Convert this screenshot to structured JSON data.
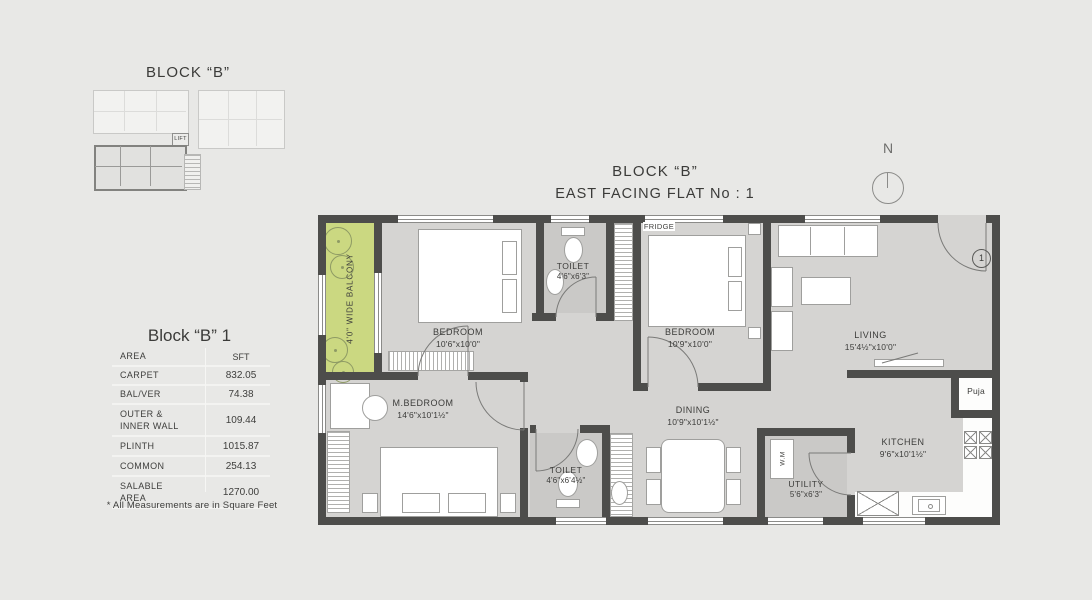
{
  "page": {
    "background": "#e8e8e6"
  },
  "colors": {
    "wall": "#4d4d4b",
    "floor": "#d5d4d2",
    "wet_floor": "#cac9c7",
    "balcony_green": "#cbd881",
    "line": "#8b8b89",
    "text": "#3e3e3c"
  },
  "mini_plan": {
    "title": "BLOCK “B”",
    "lift_label": "LIFT"
  },
  "area_table": {
    "title": "Block “B” 1",
    "header": {
      "area": "AREA",
      "sft": "SFT"
    },
    "rows": [
      {
        "label": "CARPET",
        "value": "832.05"
      },
      {
        "label": "BAL/VER",
        "value": "74.38"
      },
      {
        "label": "OUTER &\nINNER WALL",
        "value": "109.44"
      },
      {
        "label": "PLINTH",
        "value": "1015.87"
      },
      {
        "label": "COMMON",
        "value": "254.13"
      },
      {
        "label": "SALABLE\nAREA",
        "value": "1270.00"
      }
    ],
    "footnote": "* All Measurements are in Square Feet"
  },
  "plan": {
    "title_line1": "BLOCK “B”",
    "title_line2": "EAST FACING FLAT No : 1",
    "north_label": "N",
    "flat_number": "1",
    "rooms": {
      "balcony": {
        "name": "4'0\" WIDE BALCONY"
      },
      "bedroom1": {
        "name": "BEDROOM",
        "dim": "10'6\"x10'0\""
      },
      "toilet1": {
        "name": "TOILET",
        "dim": "4'6\"x6'3\""
      },
      "bedroom2": {
        "name": "BEDROOM",
        "dim": "10'9\"x10'0\""
      },
      "living": {
        "name": "LIVING",
        "dim": "15'4½\"x10'0\""
      },
      "puja": {
        "name": "Puja"
      },
      "mbedroom": {
        "name": "M.BEDROOM",
        "dim": "14'6\"x10'1½\""
      },
      "toilet2": {
        "name": "TOILET",
        "dim": "4'6\"x6'4½\""
      },
      "dining": {
        "name": "DINING",
        "dim": "10'9\"x10'1½\""
      },
      "utility": {
        "name": "UTILITY",
        "dim": "5'6\"x6'3\""
      },
      "kitchen": {
        "name": "KITCHEN",
        "dim": "9'6\"x10'1½\""
      },
      "fridge": {
        "name": "FRIDGE"
      },
      "wm": {
        "name": "W.M"
      }
    }
  }
}
